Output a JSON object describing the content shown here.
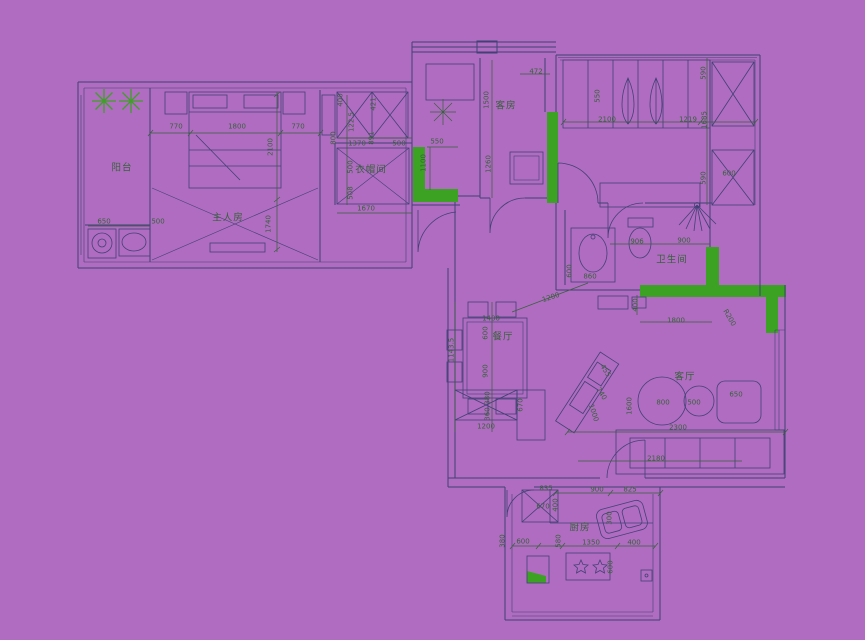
{
  "colors": {
    "background": "#b06cc0",
    "walls": "#414175",
    "annotations": "#37623c",
    "accent": "#3ca223"
  },
  "plan": {
    "rooms": [
      {
        "id": "balcony",
        "label": "阳台",
        "x": 122,
        "y": 168
      },
      {
        "id": "master-bedroom",
        "label": "主人房",
        "x": 228,
        "y": 218
      },
      {
        "id": "cloakroom",
        "label": "衣帽间",
        "x": 371,
        "y": 170
      },
      {
        "id": "guest-room",
        "label": "客房",
        "x": 506,
        "y": 106
      },
      {
        "id": "bathroom",
        "label": "卫生间",
        "x": 672,
        "y": 260
      },
      {
        "id": "dining-room",
        "label": "餐厅",
        "x": 503,
        "y": 337
      },
      {
        "id": "living-room",
        "label": "客厅",
        "x": 685,
        "y": 377
      },
      {
        "id": "kitchen",
        "label": "厨房",
        "x": 580,
        "y": 528
      }
    ],
    "dims": [
      [
        "770",
        176,
        127
      ],
      [
        "1800",
        237,
        127
      ],
      [
        "770",
        298,
        127
      ],
      [
        "2100",
        271,
        147,
        -90
      ],
      [
        "1740",
        269,
        224,
        -90
      ],
      [
        "650",
        104,
        222
      ],
      [
        "500",
        158,
        222
      ],
      [
        "400",
        341,
        100,
        -90
      ],
      [
        "421",
        374,
        104,
        -90
      ],
      [
        "122.5",
        352,
        122,
        -90
      ],
      [
        "800",
        334,
        138,
        -90
      ],
      [
        "891",
        372,
        138,
        -90
      ],
      [
        "1370",
        357,
        144
      ],
      [
        "500",
        399,
        144
      ],
      [
        "500",
        351,
        167,
        -90
      ],
      [
        "508",
        351,
        193,
        -90
      ],
      [
        "1670",
        366,
        209
      ],
      [
        "550",
        437,
        142
      ],
      [
        "1100",
        424,
        163,
        -90
      ],
      [
        "1500",
        487,
        100,
        -90
      ],
      [
        "1260",
        489,
        164,
        -90
      ],
      [
        "472",
        536,
        72
      ],
      [
        "550",
        598,
        96,
        -90
      ],
      [
        "2100",
        607,
        120
      ],
      [
        "1219",
        688,
        120
      ],
      [
        "590",
        704,
        73,
        -90
      ],
      [
        "1685",
        705,
        120,
        -90
      ],
      [
        "590",
        704,
        178,
        -90
      ],
      [
        "600",
        729,
        174
      ],
      [
        "906",
        637,
        242
      ],
      [
        "900",
        684,
        241
      ],
      [
        "600",
        570,
        271,
        -90
      ],
      [
        "860",
        590,
        277
      ],
      [
        "400",
        636,
        305,
        -90
      ],
      [
        "1800",
        676,
        321
      ],
      [
        "R200",
        729,
        318,
        60
      ],
      [
        "1200",
        551,
        298,
        -18
      ],
      [
        "1400",
        491,
        319
      ],
      [
        "600",
        486,
        333,
        -90
      ],
      [
        "900",
        486,
        371,
        -90
      ],
      [
        "1143.5",
        452,
        350,
        -90
      ],
      [
        "380",
        488,
        398,
        -90
      ],
      [
        "360",
        488,
        414,
        -90
      ],
      [
        "670",
        521,
        405,
        -90
      ],
      [
        "1200",
        486,
        427
      ],
      [
        "455",
        605,
        371,
        58
      ],
      [
        "740",
        601,
        394,
        58
      ],
      [
        "1000",
        593,
        413,
        72
      ],
      [
        "1600",
        630,
        406,
        -90
      ],
      [
        "800",
        663,
        403
      ],
      [
        "500",
        694,
        403
      ],
      [
        "650",
        736,
        395
      ],
      [
        "2300",
        678,
        428
      ],
      [
        "2180",
        656,
        459
      ],
      [
        "835",
        546,
        489
      ],
      [
        "900",
        597,
        490
      ],
      [
        "825",
        630,
        490
      ],
      [
        "670",
        543,
        507
      ],
      [
        "400",
        556,
        505,
        -90
      ],
      [
        "600",
        523,
        542
      ],
      [
        "580",
        559,
        541,
        -90
      ],
      [
        "1350",
        591,
        543
      ],
      [
        "400",
        634,
        543
      ],
      [
        "380",
        503,
        541,
        -90
      ],
      [
        "300",
        610,
        518,
        -90
      ],
      [
        "600",
        611,
        567,
        -90
      ]
    ]
  }
}
